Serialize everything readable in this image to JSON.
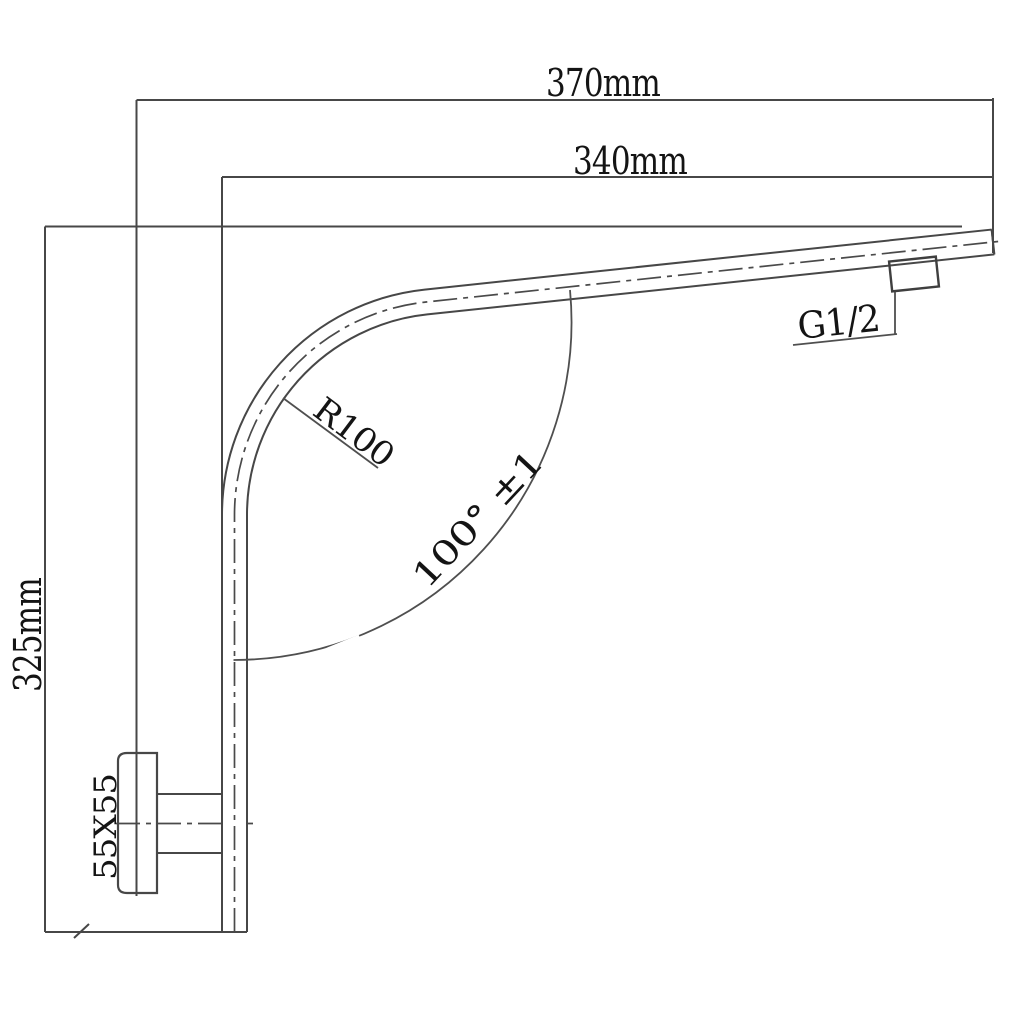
{
  "labels": {
    "dim_overall_length": "370mm",
    "dim_arm_length": "340mm",
    "dim_height": "325mm",
    "bend_radius": "R100",
    "bend_angle": "100° ±1",
    "thread_size": "G1/2",
    "flange_size": "55X55"
  },
  "colors": {
    "line": "#474747",
    "text": "#141414",
    "background": "#ffffff"
  }
}
